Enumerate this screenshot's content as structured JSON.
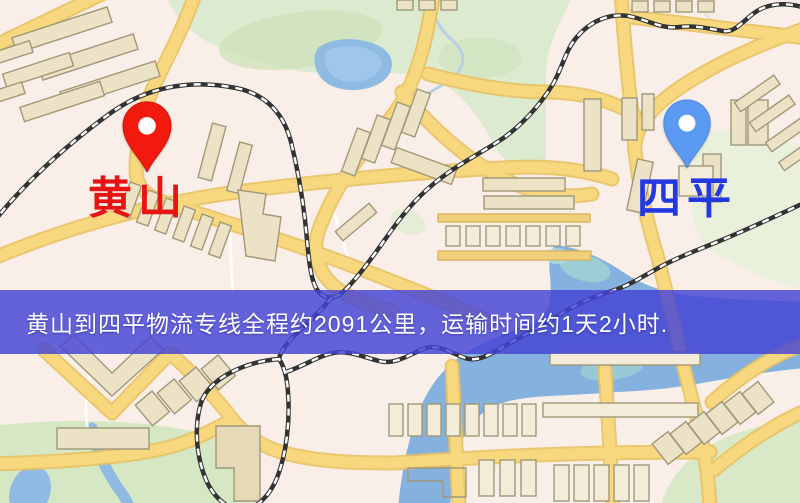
{
  "map": {
    "origin": {
      "label": "黄山",
      "label_color": "#e81414",
      "pin_color": "#f2190d",
      "pin_icon": "location-pin"
    },
    "destination": {
      "label": "四平",
      "label_color": "#2438e2",
      "pin_color": "#5b9af2",
      "pin_icon": "location-pin"
    },
    "banner": {
      "text": "黄山到四平物流专线全程约2091公里，运输时间约1天2小时.",
      "distance": "约2091公里",
      "duration": "约1天2小时",
      "background": "#4343d5",
      "text_color": "#ffffff"
    },
    "style_colors": {
      "background": "#f8f0e9",
      "road": "#f7d87e",
      "road_edge": "#e9c263",
      "building": "#ece3c6",
      "building_outline": "#a09878",
      "park": "#dcead0",
      "water": "#84b1de",
      "railway": "#333333"
    }
  }
}
